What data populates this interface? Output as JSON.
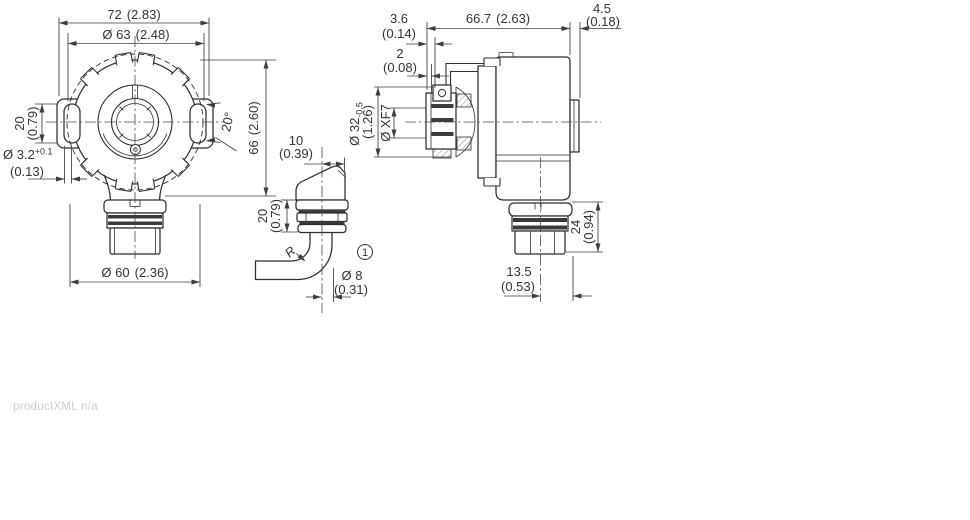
{
  "drawing": {
    "front": {
      "width_mm": "72",
      "width_in": "(2.83)",
      "bolt_circle_mm": "Ø 63",
      "bolt_circle_in": "(2.48)",
      "slot_len_mm": "20",
      "slot_len_in": "(0.79)",
      "slot_w_mm": "Ø 3.2",
      "slot_w_tol": "+0.1",
      "slot_w_in": "(0.13)",
      "slot_angle": "20°",
      "height_mm": "66",
      "height_in": "(2.60)",
      "pilot_mm": "Ø 60",
      "pilot_in": "(2.36)"
    },
    "cable": {
      "offset_mm": "10",
      "offset_in": "(0.39)",
      "gland_mm": "20",
      "gland_in": "(0.79)",
      "bend_radius": "R",
      "callout": "1",
      "dia_mm": "Ø 8",
      "dia_in": "(0.31)"
    },
    "side": {
      "spring_mm": "3.6",
      "spring_in": "(0.14)",
      "slot_depth_mm": "2",
      "slot_depth_in": "(0.08)",
      "length_mm": "66.7",
      "length_in": "(2.63)",
      "cap_mm": "4.5",
      "cap_in": "(0.18)",
      "clamp_mm": "Ø 32",
      "clamp_tol": "-0.5",
      "clamp_in": "(1.26)",
      "bore_label": "Ø XF7",
      "conn_h_mm": "24",
      "conn_h_in": "(0.94)",
      "conn_off_mm": "13.5",
      "conn_off_in": "(0.53)"
    }
  },
  "footer": {
    "note": "productXML n/a"
  },
  "colors": {
    "outline": "#2e2e2e",
    "dimension": "#3d3d3d",
    "text": "#333333",
    "footer_text": "#cccccc",
    "background": "#ffffff"
  }
}
